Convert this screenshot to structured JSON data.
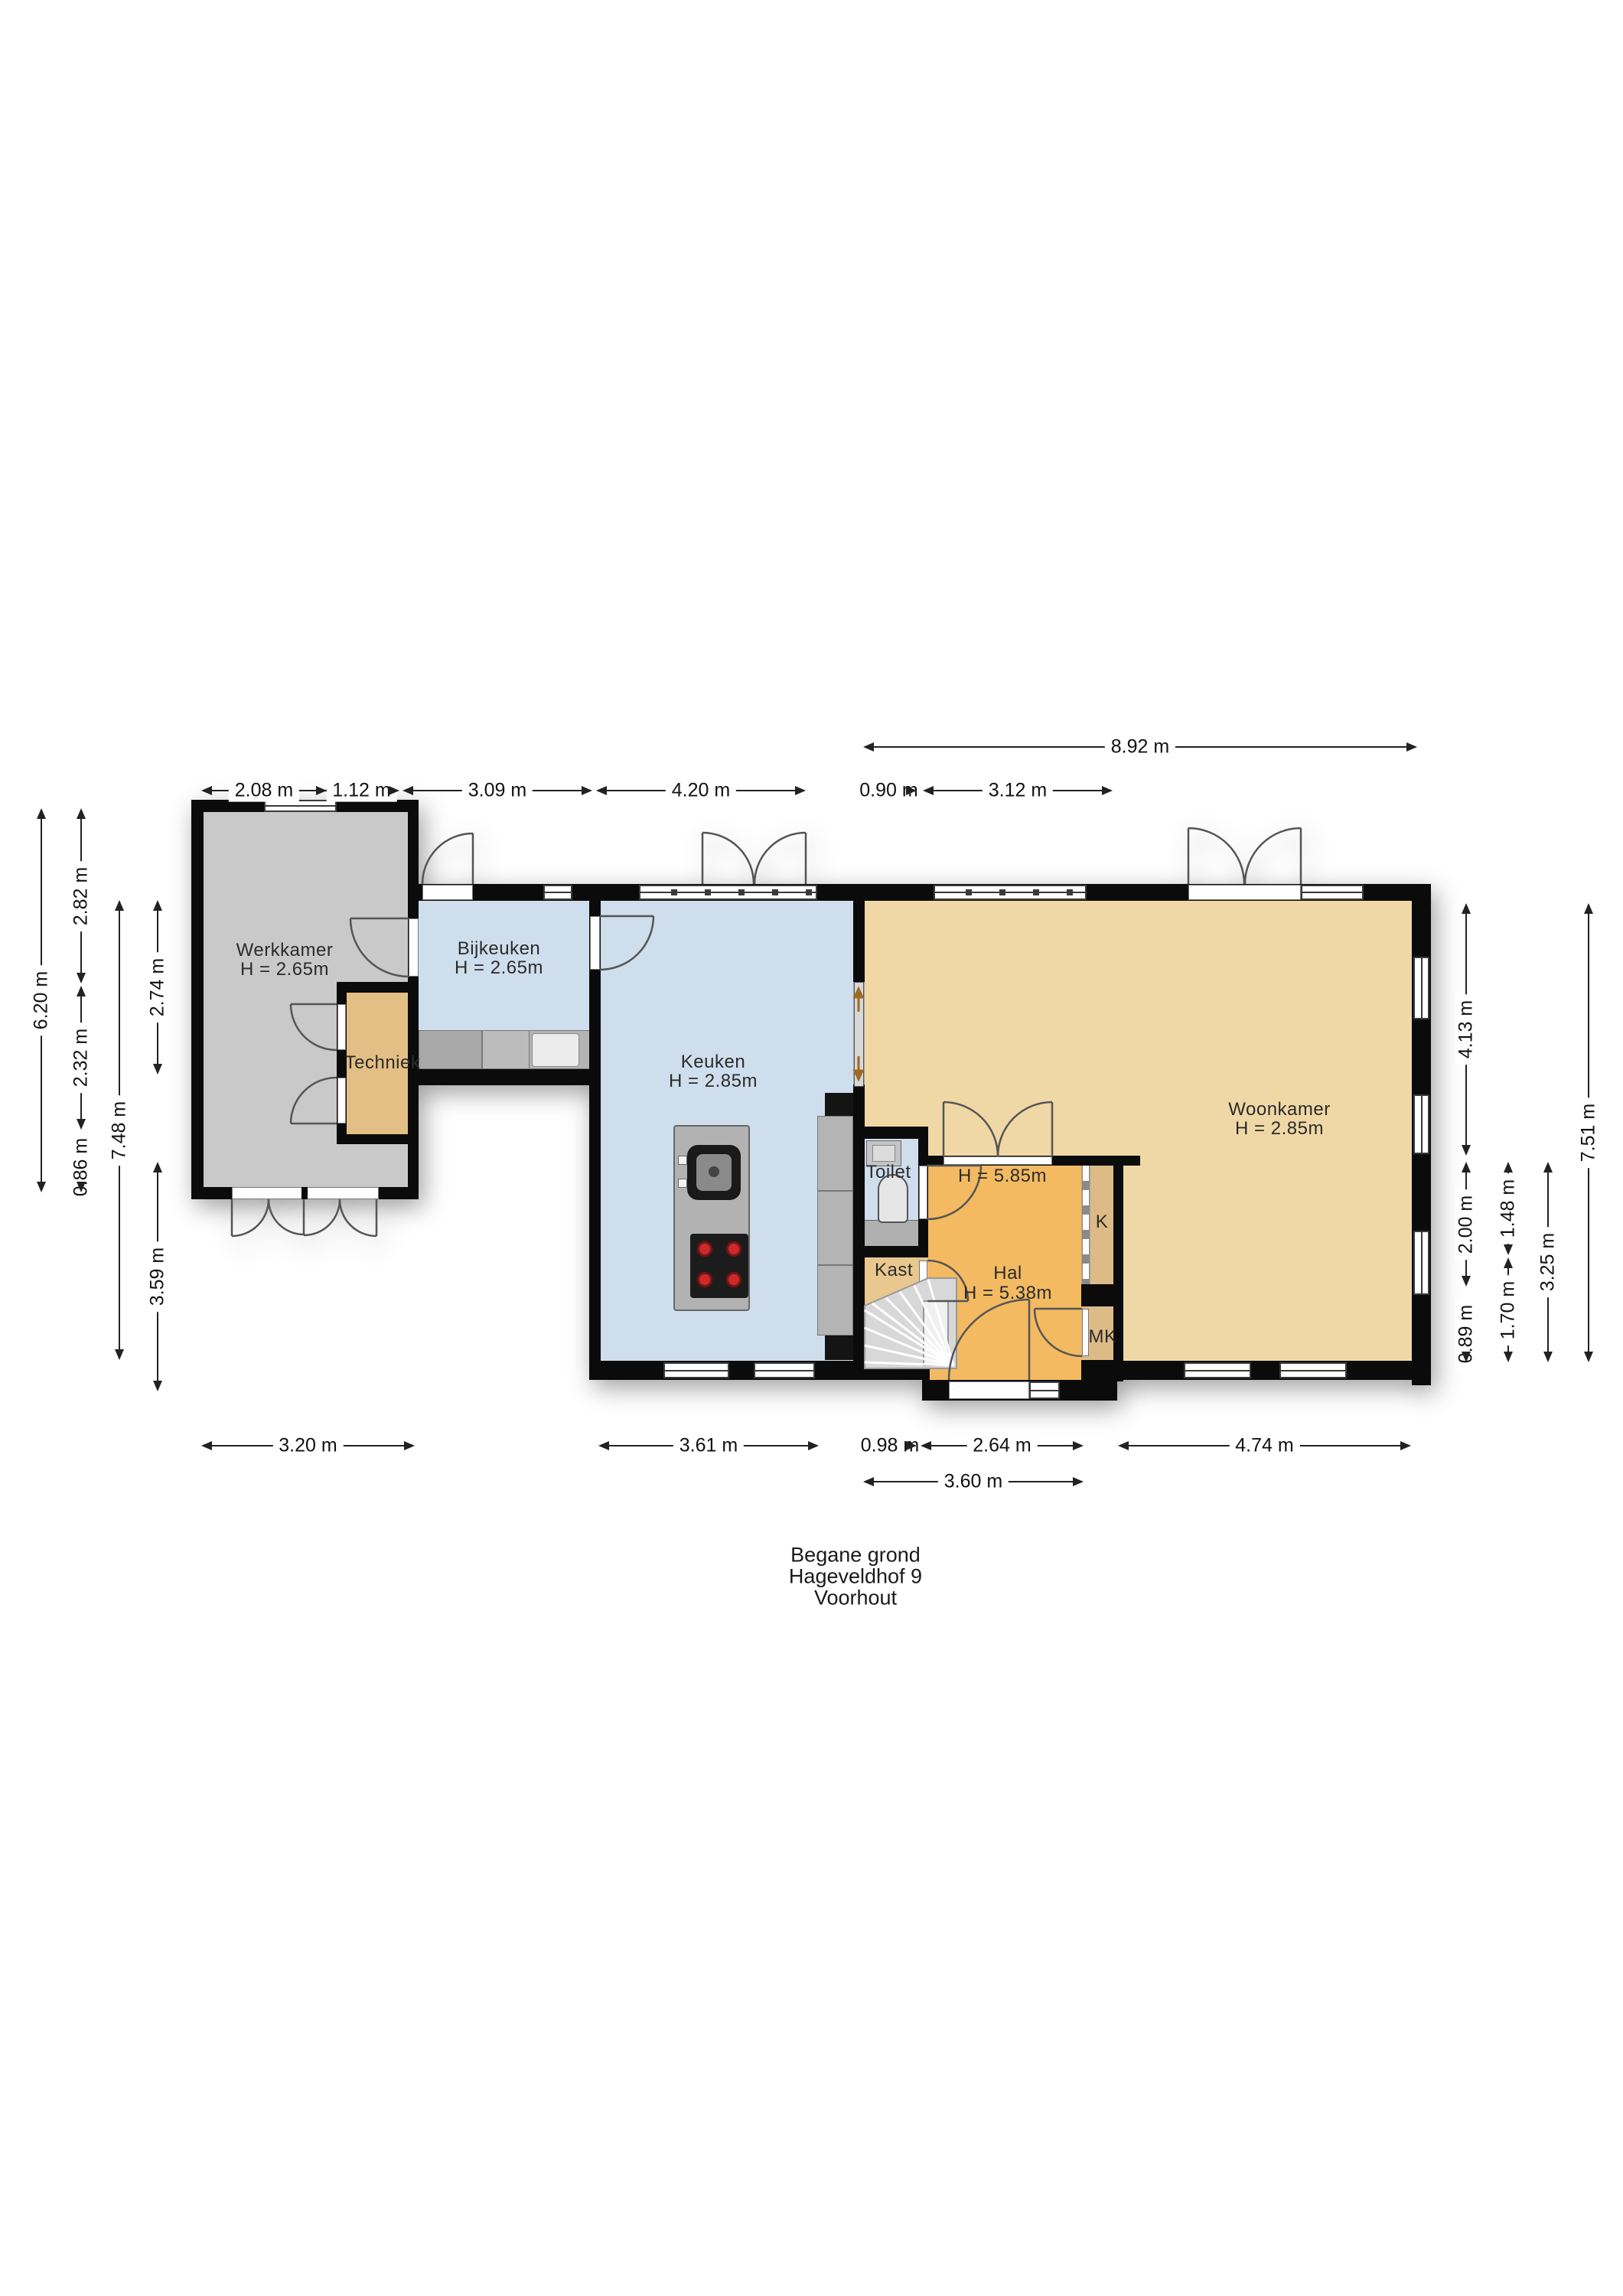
{
  "title": {
    "lines": [
      "Begane grond",
      "Hageveldhof 9",
      "Voorhout"
    ]
  },
  "rooms": {
    "werkkamer": {
      "name": "Werkkamer",
      "height": "H = 2.65m"
    },
    "bijkeuken": {
      "name": "Bijkeuken",
      "height": "H = 2.65m"
    },
    "keuken": {
      "name": "Keuken",
      "height": "H = 2.85m"
    },
    "woonkamer": {
      "name": "Woonkamer",
      "height": "H = 2.85m"
    },
    "hal": {
      "name": "Hal",
      "height": "H = 5.38m",
      "void_height": "H = 5.85m"
    },
    "techniek": {
      "name": "Techniek"
    },
    "toilet": {
      "name": "Toilet"
    },
    "kast": {
      "name": "Kast"
    },
    "k": {
      "name": "K"
    },
    "mk": {
      "name": "MK"
    }
  },
  "dimensions": {
    "top": [
      "8.92 m",
      "2.08 m",
      "1.12 m",
      "3.09 m",
      "4.20 m",
      "0.90 m",
      "3.12 m"
    ],
    "bottom": [
      "3.20 m",
      "3.61 m",
      "0.98 m",
      "2.64 m",
      "4.74 m",
      "3.60 m"
    ],
    "left": [
      "6.20 m",
      "2.82 m",
      "2.32 m",
      "0.86 m",
      "7.48 m",
      "2.74 m",
      "3.59 m"
    ],
    "right": [
      "4.13 m",
      "2.00 m",
      "0.89 m",
      "1.48 m",
      "1.70 m",
      "3.25 m",
      "7.51 m"
    ]
  },
  "colors": {
    "wall": "#0b0b0b",
    "werkkamer_floor": "#c9c9c9",
    "techniek_floor": "#e3be85",
    "bijkeuken_keuken_floor": "#cfdeed",
    "woonkamer_floor": "#f0d8a6",
    "hal_floor": "#f3ba62",
    "closet_floor": "#ddbb87",
    "toilet_floor": "#cfdeed",
    "counter": "#b4b4b4",
    "stove_burner": "#cc2a2a"
  }
}
